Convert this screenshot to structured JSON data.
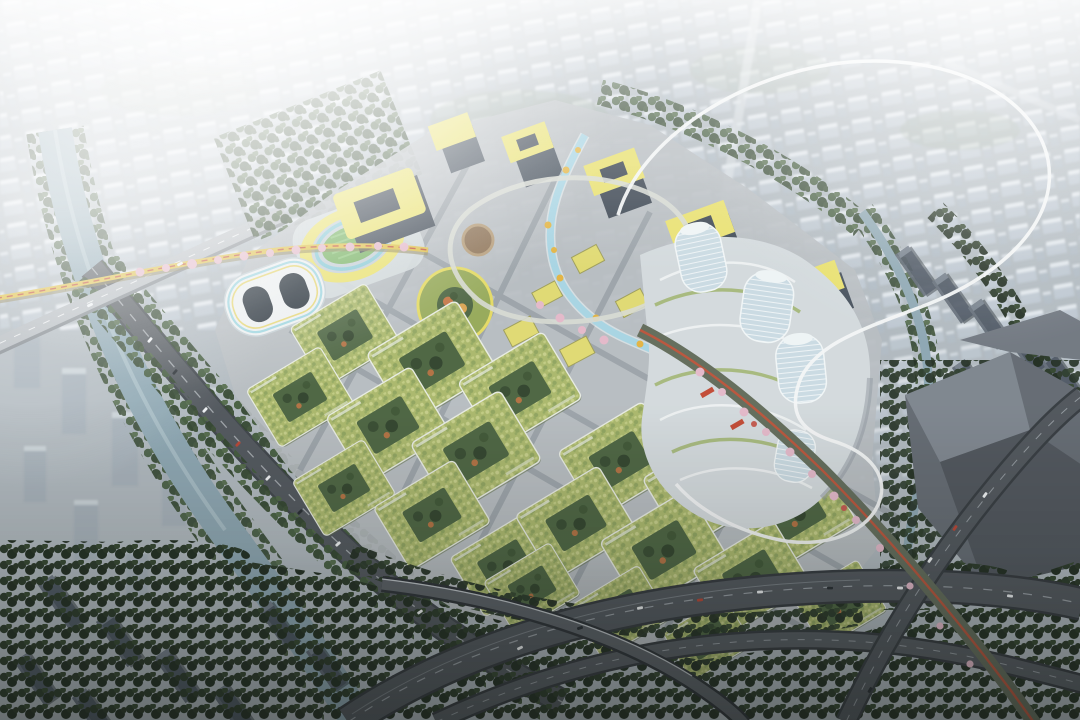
{
  "image": {
    "kind": "aerial-architectural-rendering",
    "description": "Bird's-eye rendering of a mixed-use urban masterplan: green-roofed courtyard housing blocks, a yellow-roofed commercial core with a winding blue stream, an oval stadium, white twisting glass towers on terraced podiums, a thin white elevated loop, an orange skywalk lined with pink blossom trees, canals, tree-lined highways with traffic, dark residential slabs in the foreground and hazy white city blocks dissolving into glare at the top left.",
    "visible_text": []
  },
  "palette": {
    "base": "#aeb7bd",
    "far_city": "#bdc7d0",
    "far_city_top": "#e2e8ed",
    "water": "#8aa4b0",
    "stream": "#a5d3e2",
    "tree_dark": "#202d20",
    "tree_mid": "#33482f",
    "pavement": "#b5bbbf",
    "road": "#4c5258",
    "road_light": "#b3b9be",
    "green_roof": "#a8b668",
    "green_roof_light": "#c4cd86",
    "courtyard": "#47603c",
    "yellow_accent": "#e8e06c",
    "facade_dark": "#3b4551",
    "white_building": "#eceff0",
    "tower_glass": "#c9dae2",
    "podium": "#d2d9dc",
    "dark_building": "#5f666e",
    "slab": "#434d59",
    "slab_top": "#6e7985",
    "blossom": "#e3b7c8",
    "skywalk_yellow": "#ddbf45",
    "skywalk_red": "#c24e33",
    "loop_white": "#f3f6f6",
    "field_green": "#76b161",
    "track_blue": "#87c9d5"
  },
  "scene": {
    "landmarks": [
      "hazy far city blocks",
      "left canal with road bridge",
      "oval stadium with yellow rim",
      "white striped courtyard building",
      "green crescent podium",
      "yellow-roofed office cluster",
      "blue stream plaza",
      "green-roof residential courtyard blocks",
      "twisting white glass towers on terraced podium",
      "thin white elevated loop",
      "blossom-lined elevated skywalk",
      "tree-lined highway interchange",
      "dark sculptural building",
      "dark residential slab rows"
    ]
  }
}
